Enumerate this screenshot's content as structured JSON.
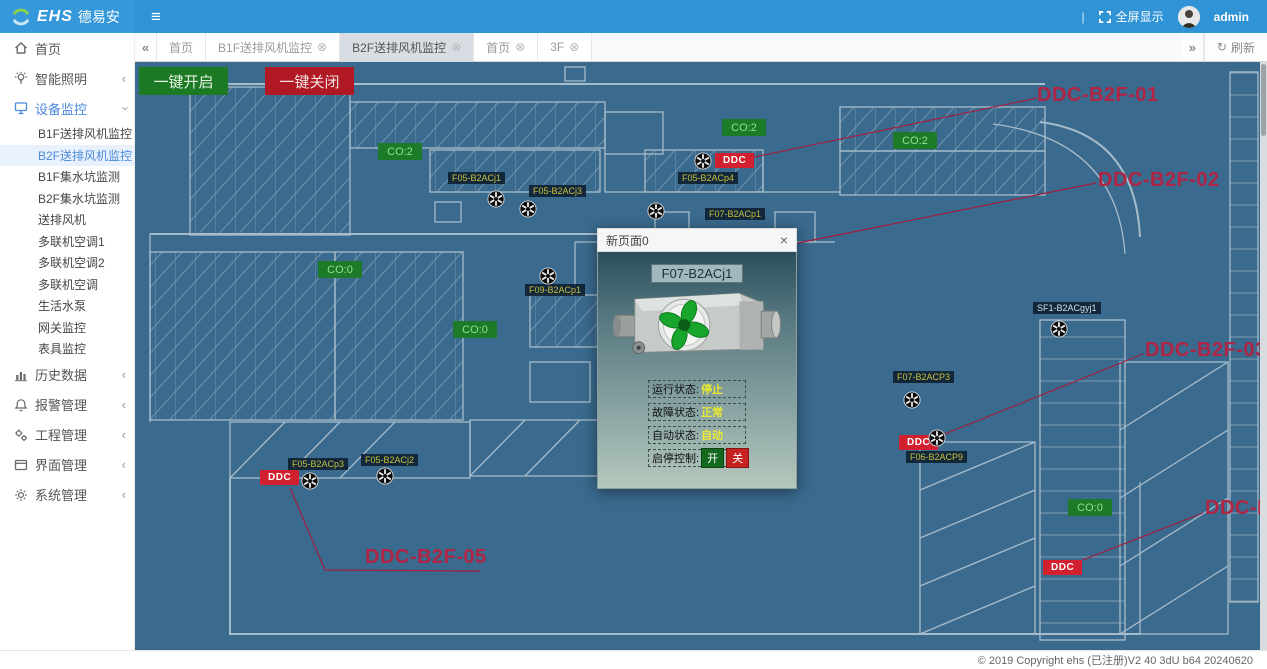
{
  "header": {
    "logo_text": "EHS",
    "logo_brand": "德易安",
    "menu_icon": "≡",
    "separator": "|",
    "fullscreen_label": "全屏显示",
    "username": "admin"
  },
  "tabs": {
    "back_icon": "«",
    "forward_icon": "»",
    "refresh_label": "刷新",
    "items": [
      {
        "id": "home-1",
        "label": "首页",
        "closable": false,
        "active": false
      },
      {
        "id": "b1f-fan",
        "label": "B1F送排风机监控",
        "closable": true,
        "active": false
      },
      {
        "id": "b2f-fan",
        "label": "B2F送排风机监控",
        "closable": true,
        "active": true
      },
      {
        "id": "home-2",
        "label": "首页",
        "closable": true,
        "active": false
      },
      {
        "id": "3f",
        "label": "3F",
        "closable": true,
        "active": false
      }
    ]
  },
  "sidebar": {
    "items": [
      {
        "id": "home",
        "icon": "home-icon",
        "label": "首页"
      },
      {
        "id": "lighting",
        "icon": "bulb-icon",
        "label": "智能照明",
        "chevron": "collapsed"
      },
      {
        "id": "device-monitor",
        "icon": "monitor-icon",
        "label": "设备监控",
        "chevron": "expanded",
        "expanded": true,
        "children": [
          {
            "id": "b1f-fan-monitor",
            "label": "B1F送排风机监控",
            "active": false
          },
          {
            "id": "b2f-fan-monitor",
            "label": "B2F送排风机监控",
            "active": true
          },
          {
            "id": "b1f-sump-monitor",
            "label": "B1F集水坑监测",
            "active": false
          },
          {
            "id": "b2f-sump-monitor",
            "label": "B2F集水坑监测",
            "active": false
          },
          {
            "id": "supply-exhaust-fan",
            "label": "送排风机",
            "active": false
          },
          {
            "id": "vrf-ac-1",
            "label": "多联机空调1",
            "active": false
          },
          {
            "id": "vrf-ac-2",
            "label": "多联机空调2",
            "active": false
          },
          {
            "id": "vrf-ac",
            "label": "多联机空调",
            "active": false
          },
          {
            "id": "domestic-pump",
            "label": "生活水泵",
            "active": false
          },
          {
            "id": "gateway-monitor",
            "label": "网关监控",
            "active": false
          },
          {
            "id": "meter-monitor",
            "label": "表具监控",
            "active": false
          }
        ]
      },
      {
        "id": "history-data",
        "icon": "chart-icon",
        "label": "历史数据",
        "chevron": "collapsed"
      },
      {
        "id": "alarm-mgmt",
        "icon": "alarm-icon",
        "label": "报警管理",
        "chevron": "collapsed"
      },
      {
        "id": "engineering-mgmt",
        "icon": "tools-icon",
        "label": "工程管理",
        "chevron": "collapsed"
      },
      {
        "id": "interface-mgmt",
        "icon": "window-icon",
        "label": "界面管理",
        "chevron": "collapsed"
      },
      {
        "id": "system-mgmt",
        "icon": "gear-icon",
        "label": "系统管理",
        "chevron": "collapsed"
      }
    ]
  },
  "canvas": {
    "open_all_label": "一键开启",
    "close_all_label": "一键关闭",
    "co_badges": [
      {
        "text": "CO:2",
        "x": 243,
        "y": 81
      },
      {
        "text": "CO:2",
        "x": 587,
        "y": 57
      },
      {
        "text": "CO:2",
        "x": 758,
        "y": 70
      },
      {
        "text": "CO:0",
        "x": 183,
        "y": 199
      },
      {
        "text": "CO:0",
        "x": 318,
        "y": 259
      },
      {
        "text": "CO:0",
        "x": 933,
        "y": 437
      }
    ],
    "ddc_badge_text": "DDC",
    "ddc_badges": [
      {
        "x": 580,
        "y": 91
      },
      {
        "x": 764,
        "y": 373
      },
      {
        "x": 125,
        "y": 408
      },
      {
        "x": 908,
        "y": 498
      }
    ],
    "device_chips": [
      {
        "text": "F05-B2ACj1",
        "x": 313,
        "y": 110
      },
      {
        "text": "F05-B2ACj3",
        "x": 394,
        "y": 123
      },
      {
        "text": "F05-B2ACp4",
        "x": 543,
        "y": 110
      },
      {
        "text": "F07-B2ACp1",
        "x": 570,
        "y": 146
      },
      {
        "text": "F09-B2ACp1",
        "x": 390,
        "y": 222
      },
      {
        "text": "SF1-B2ACgyj1",
        "x": 898,
        "y": 240,
        "light": true
      },
      {
        "text": "F07-B2ACP3",
        "x": 758,
        "y": 309
      },
      {
        "text": "F06-B2ACP9",
        "x": 771,
        "y": 389
      },
      {
        "text": "F05-B2ACp3",
        "x": 153,
        "y": 396
      },
      {
        "text": "F05-B2ACj2",
        "x": 226,
        "y": 392
      }
    ],
    "fans": [
      {
        "x": 352,
        "y": 128
      },
      {
        "x": 384,
        "y": 138
      },
      {
        "x": 559,
        "y": 90
      },
      {
        "x": 512,
        "y": 140
      },
      {
        "x": 404,
        "y": 205
      },
      {
        "x": 915,
        "y": 258
      },
      {
        "x": 768,
        "y": 329
      },
      {
        "x": 793,
        "y": 367
      },
      {
        "x": 166,
        "y": 410
      },
      {
        "x": 241,
        "y": 405
      }
    ],
    "ddc_labels": [
      {
        "text": "DDC-B2F-01",
        "x": 902,
        "y": 22
      },
      {
        "text": "DDC-B2F-02",
        "x": 963,
        "y": 107
      },
      {
        "text": "DDC-B2F-03",
        "x": 1010,
        "y": 277
      },
      {
        "text": "DDC-B2F-04",
        "x": 1070,
        "y": 435
      },
      {
        "text": "DDC-B2F-05",
        "x": 230,
        "y": 484
      }
    ],
    "leader_lines": [
      [
        [
          610,
          97
        ],
        [
          902,
          36
        ]
      ],
      [
        [
          663,
          181
        ],
        [
          961,
          121
        ]
      ],
      [
        [
          800,
          376
        ],
        [
          1008,
          292
        ]
      ],
      [
        [
          940,
          501
        ],
        [
          1068,
          451
        ]
      ],
      [
        [
          155,
          426
        ],
        [
          190,
          508
        ],
        [
          345,
          509
        ]
      ]
    ]
  },
  "dialog": {
    "title": "新页面0",
    "close_icon": "×",
    "device_name": "F07-B2ACj1",
    "rows": [
      {
        "label": "运行状态:",
        "value": "停止"
      },
      {
        "label": "故障状态:",
        "value": "正常"
      },
      {
        "label": "自动状态:",
        "value": "自动"
      }
    ],
    "control_label": "启停控制:",
    "on_label": "开",
    "off_label": "关"
  },
  "footer": {
    "copyright": "© 2019 Copyright ehs (已注册)V2 40 3dU b64 20240620"
  },
  "colors": {
    "topbar": "#3093d5",
    "canvas_bg": "#3a6a8e",
    "green_badge": "#1c7a28",
    "red_badge": "#d2202e",
    "ddc_label_text": "#b02444",
    "chip_text": "#c6c03d",
    "status_value": "#e8e832",
    "open_button": "#1d7a24",
    "close_button": "#b01824"
  }
}
